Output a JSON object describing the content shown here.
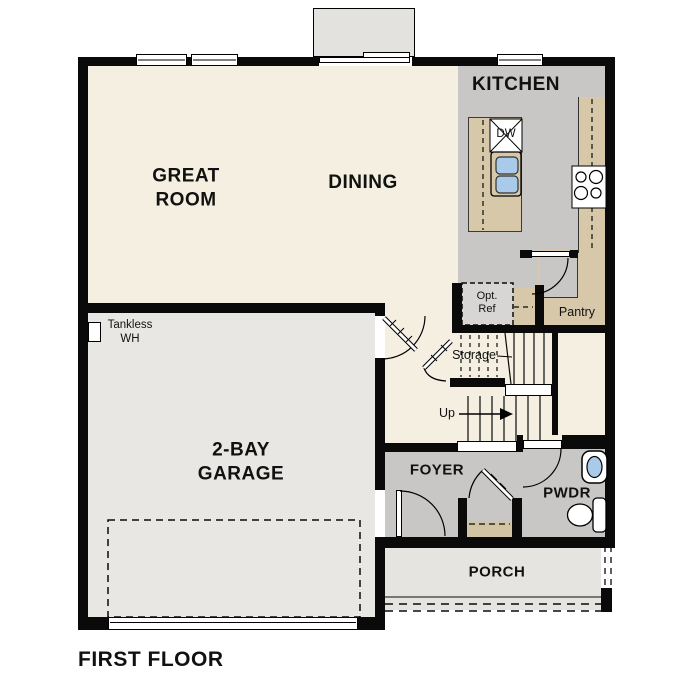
{
  "title": "FIRST FLOOR",
  "colors": {
    "wall": "#0a0a0a",
    "cream": "#f5efe2",
    "gray": "#c8c7c5",
    "garage": "#e8e7e4",
    "porch": "#e5e4e1",
    "alcove": "#e3e2df",
    "tan": "#d7c8aa",
    "closet_tan": "#d2c4a5",
    "optref": "#d7d6d4",
    "blue": "#a9cae9",
    "text": "#111111"
  },
  "rooms": {
    "great_room": {
      "label": "GREAT\nROOM"
    },
    "dining": {
      "label": "DINING"
    },
    "kitchen": {
      "label": "KITCHEN"
    },
    "garage": {
      "label": "2-BAY\nGARAGE"
    },
    "foyer": {
      "label": "FOYER"
    },
    "powder": {
      "label": "PWDR"
    },
    "porch": {
      "label": "PORCH"
    },
    "pantry": {
      "label": "Pantry"
    },
    "storage": {
      "label": "Storage"
    }
  },
  "annotations": {
    "stair_direction": "Up",
    "dishwasher": "DW",
    "optional_refrigerator": "Opt.\nRef",
    "tankless_water_heater": "Tankless\nWH"
  }
}
